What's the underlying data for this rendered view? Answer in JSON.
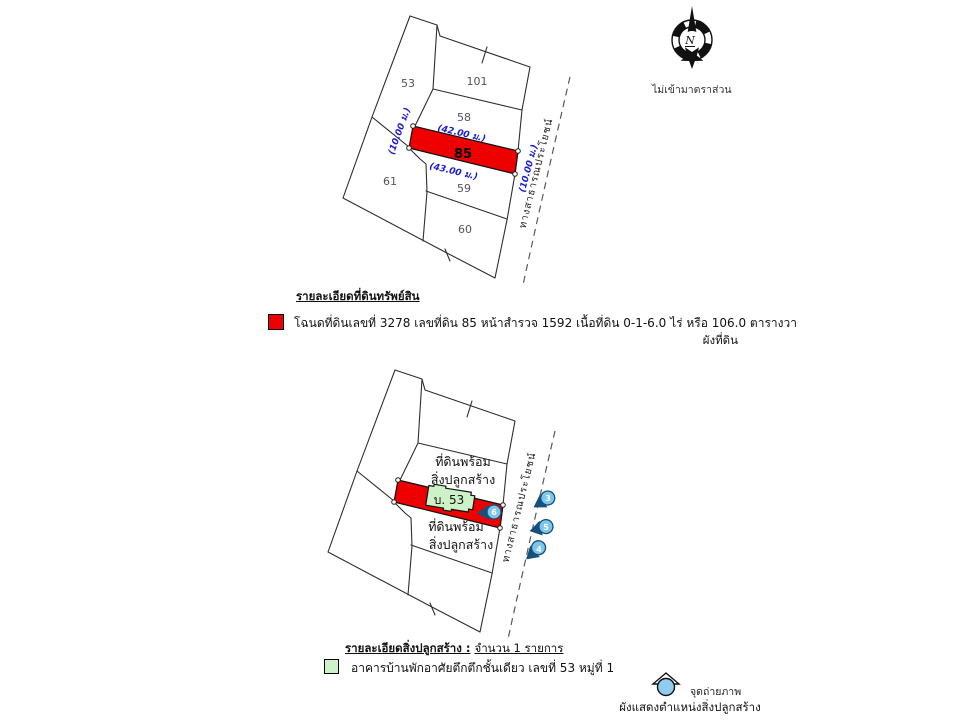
{
  "colors": {
    "parcel_highlight": "#ee0000",
    "dimension_text": "#1d1dd6",
    "building_fill": "#cdf2c8",
    "camera_blue": "#7ec6ea"
  },
  "compass": {
    "letter": "N",
    "scale_note": "ไม่เข้ามาตราส่วน"
  },
  "land_plan": {
    "caption": "ผังที่ดิน",
    "parcels": {
      "p53": "53",
      "p101": "101",
      "p58": "58",
      "p85": "85",
      "p61": "61",
      "p59": "59",
      "p60": "60"
    },
    "dimensions": {
      "top": "(42.00 ม.)",
      "bottom": "(43.00 ม.)",
      "left": "(10.00 ม.)",
      "right": "(10.00 ม.)"
    },
    "road_label": "ทางสาธารณประโยชน์"
  },
  "land_legend": {
    "header": "รายละเอียดที่ดินทรัพย์สิน",
    "entry": "โฉนดที่ดินเลขที่ 3278 เลขที่ดิน 85 หน้าสำรวจ 1592 เนื้อที่ดิน 0-1-6.0 ไร่ หรือ 106.0 ตารางวา"
  },
  "building_plan": {
    "caption": "ผังแสดงตำแหน่งสิ่งปลูกสร้าง",
    "note_above": {
      "line1": "ที่ดินพร้อม",
      "line2": "สิ่งปลูกสร้าง"
    },
    "note_below": {
      "line1": "ที่ดินพร้อม",
      "line2": "สิ่งปลูกสร้าง"
    },
    "building_label": "บ. 53",
    "road_label": "ทางสาธารณประโยชน์",
    "photo_points": {
      "p3": "3",
      "p5": "5",
      "p4": "4",
      "p6": "6"
    }
  },
  "building_legend": {
    "header": "รายละเอียดสิ่งปลูกสร้าง :",
    "count_note": "จำนวน 1 รายการ",
    "entry": "อาคารบ้านพักอาศัยตึกตึกชั้นเดียว เลขที่ 53 หมู่ที่ 1"
  },
  "photo_legend": {
    "label": "จุดถ่ายภาพ"
  }
}
